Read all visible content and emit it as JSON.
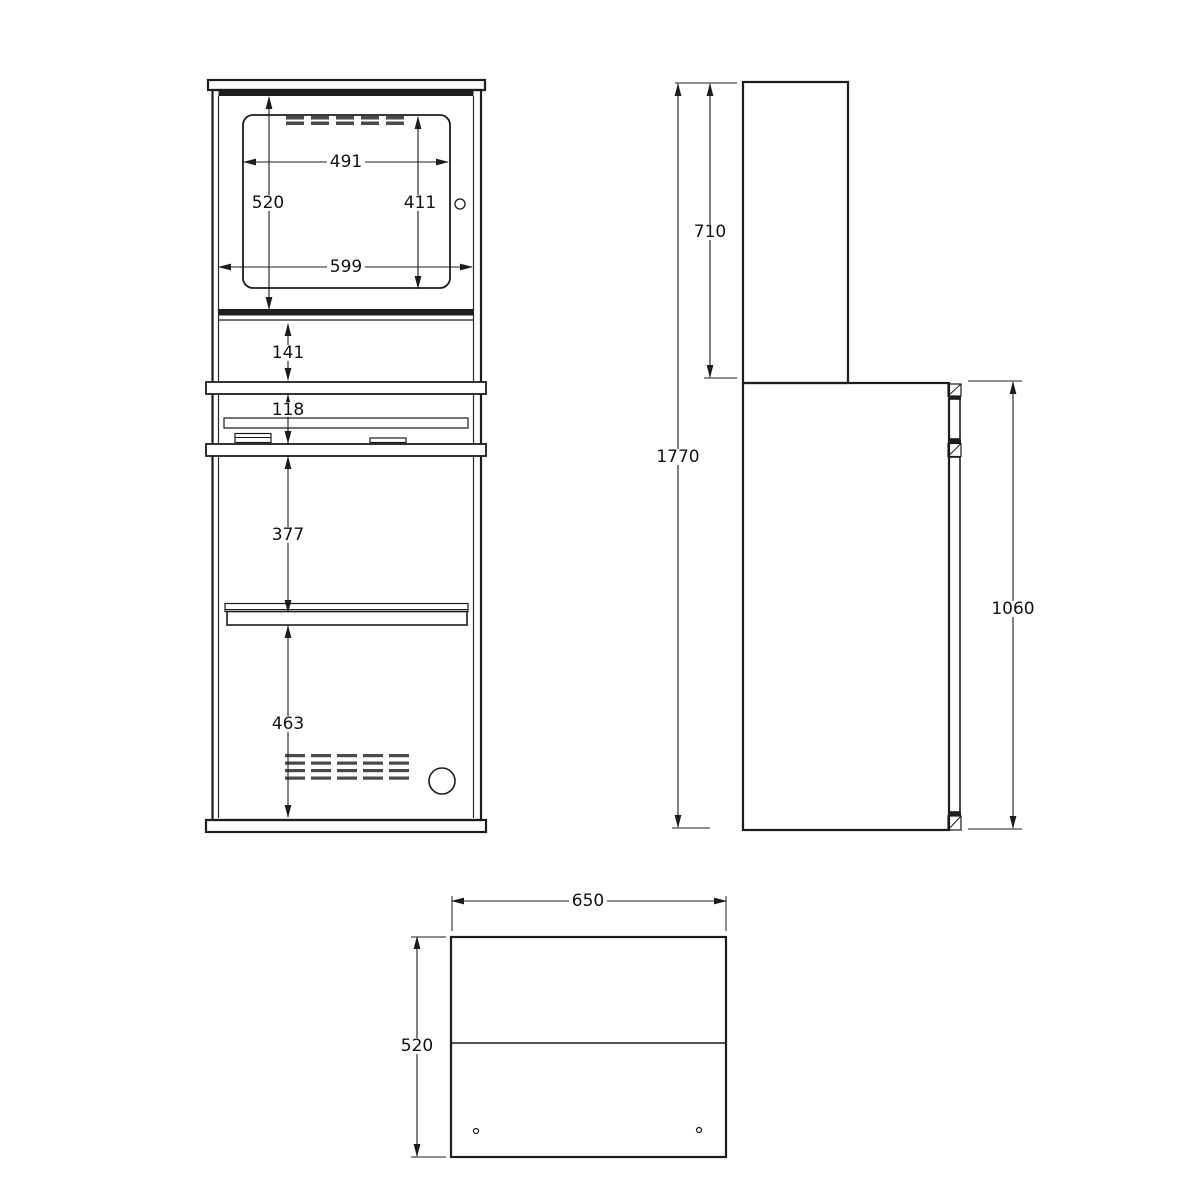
{
  "front_view": {
    "dims": {
      "bezel_width": "491",
      "window_height": "520",
      "bezel_height": "411",
      "window_width": "599",
      "upper_panel_height": "141",
      "keyboard_section_height": "118",
      "door_to_shelf": "377",
      "lower_door_height": "463"
    }
  },
  "side_view": {
    "dims": {
      "upper_section_height": "710",
      "total_height": "1770",
      "lower_section_height": "1060"
    }
  },
  "bottom_view": {
    "dims": {
      "width": "650",
      "depth": "520"
    }
  }
}
